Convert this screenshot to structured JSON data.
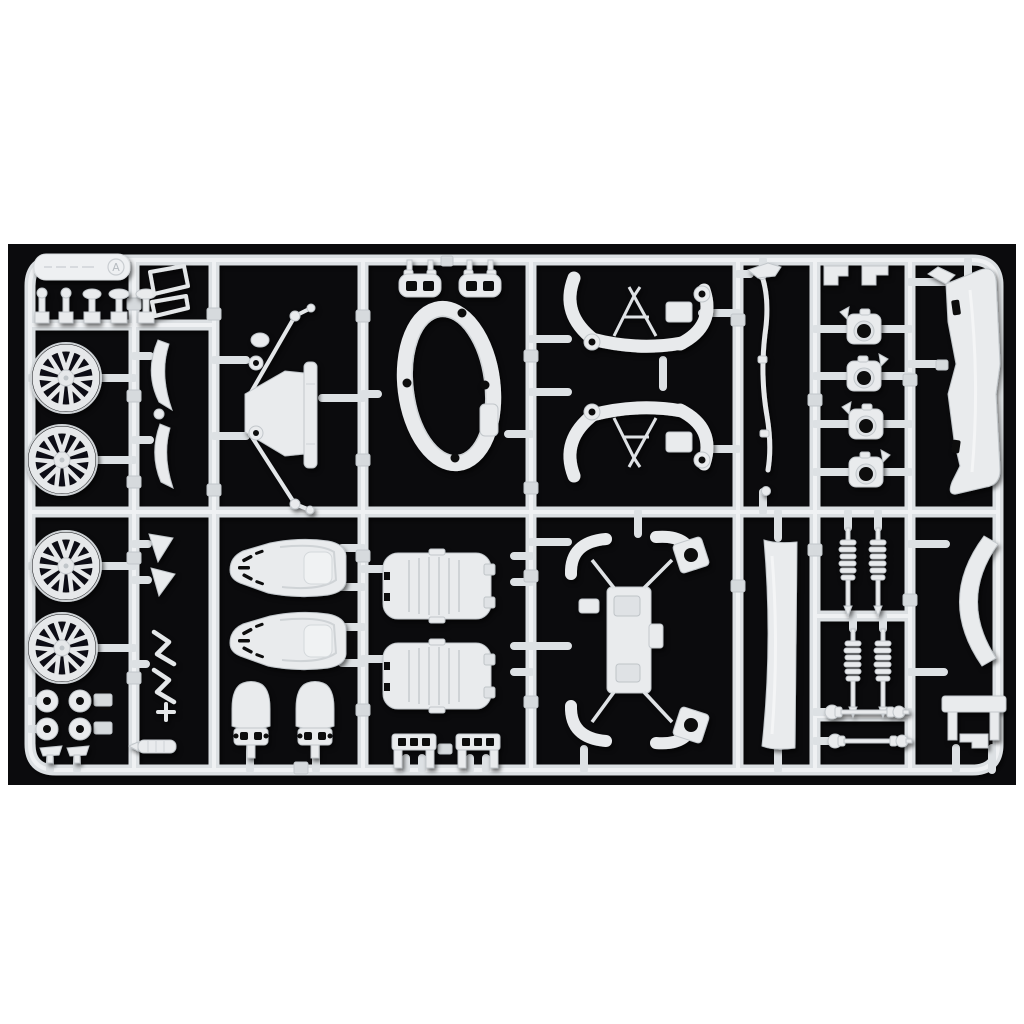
{
  "photo": {
    "page_background": "#ffffff",
    "photo_background": "#0b0b0d",
    "plastic_color": "#e9ebed",
    "runner_color": "#dde0e3",
    "description": "Plastic model car kit sprue (parts tree) in white/light-grey styrene photographed on a black background with white margins above and below",
    "sprue_letter": "A"
  },
  "sprue": {
    "label_plate": {
      "embossed_text_legible": false,
      "sprue_letter": "A"
    },
    "layout": {
      "rows": 2,
      "columns": 8,
      "frame": "rounded rectangle runner frame with internal column runners"
    },
    "parts_inventory": [
      {
        "name": "spoked-wheel",
        "count": 4
      },
      {
        "name": "hub-ring",
        "count": 4
      },
      {
        "name": "bucket-seat-shell",
        "count": 2
      },
      {
        "name": "headrest",
        "count": 2
      },
      {
        "name": "seat-cushion",
        "count": 2
      },
      {
        "name": "pedal-unit",
        "count": 2
      },
      {
        "name": "coil-spring-damper",
        "count": 4
      },
      {
        "name": "drive-shaft",
        "count": 2
      },
      {
        "name": "steering-knuckle",
        "count": 4
      },
      {
        "name": "cockpit-ring",
        "count": 1
      },
      {
        "name": "bulkhead-frame-with-braces",
        "count": 1
      },
      {
        "name": "suspension-cross-frame",
        "count": 2
      },
      {
        "name": "rear-axle-chassis-assembly",
        "count": 1
      },
      {
        "name": "front-bumper",
        "count": 1
      },
      {
        "name": "rocker-panel",
        "count": 1
      },
      {
        "name": "wheel-arch-trim",
        "count": 1
      },
      {
        "name": "mounting-bench-bracket",
        "count": 1
      },
      {
        "name": "exhaust-tip-blade",
        "count": 2
      },
      {
        "name": "air-funnel",
        "count": 2
      },
      {
        "name": "wiper-arm",
        "count": 2
      },
      {
        "name": "muffler-tip",
        "count": 1
      },
      {
        "name": "shift-lever-small-stalk",
        "count": 5
      },
      {
        "name": "window-frame-wire",
        "count": 2
      },
      {
        "name": "clamp-bracket",
        "count": 2
      },
      {
        "name": "linkage-rod",
        "count": 1
      },
      {
        "name": "angle-bracket",
        "count": 2
      },
      {
        "name": "foot-pad",
        "count": 2
      }
    ]
  }
}
